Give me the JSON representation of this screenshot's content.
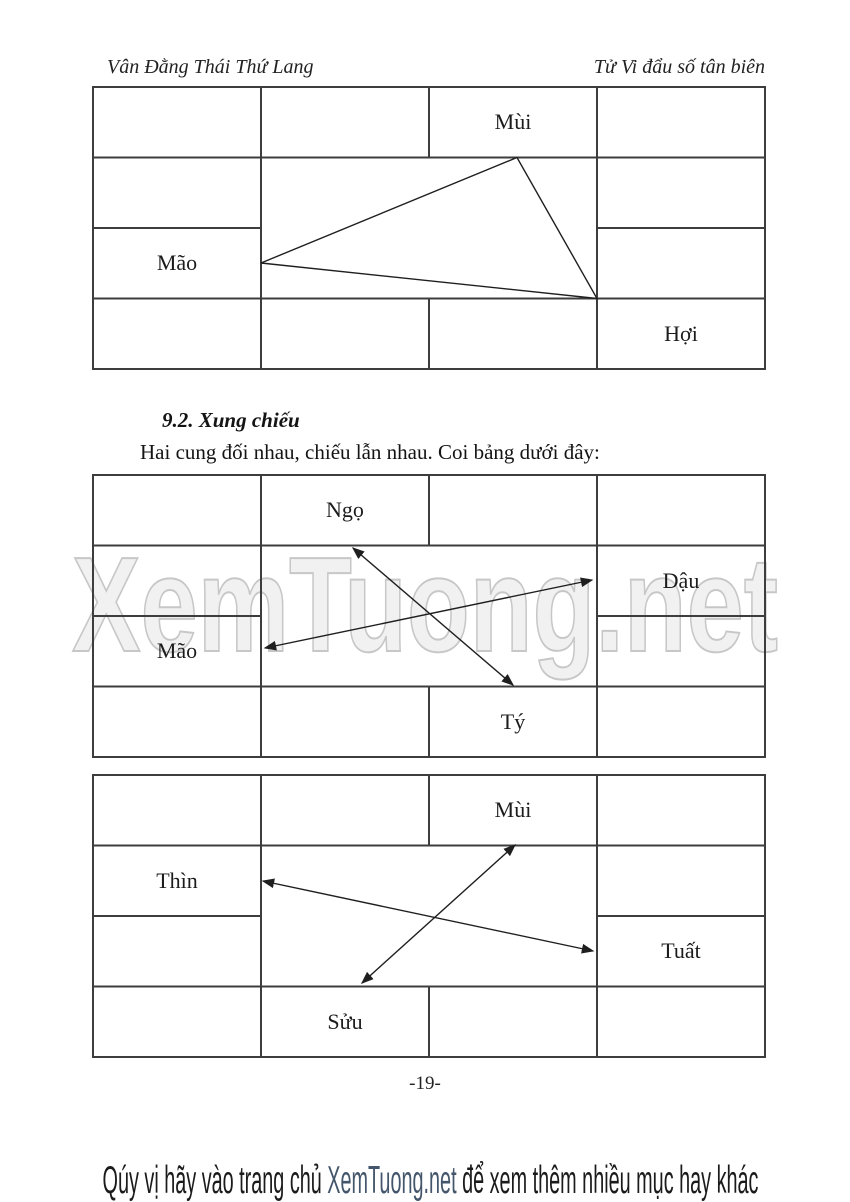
{
  "header": {
    "author": "Vân Đằng Thái Thứ Lang",
    "book_title": "Tử Vi đẩu số tân biên"
  },
  "section": {
    "heading": "9.2. Xung chiếu",
    "intro": "Hai cung đối nhau, chiếu lẫn nhau. Coi bảng dưới đây:"
  },
  "watermark": {
    "text": "XemTuong.net"
  },
  "grid_tam_hop": {
    "labels": {
      "mui": "Mùi",
      "mao": "Mão",
      "hoi": "Hợi"
    }
  },
  "grid_xung_chieu_a": {
    "labels": {
      "ngo": "Ngọ",
      "dau": "Dậu",
      "mao": "Mão",
      "ty": "Tý"
    }
  },
  "grid_xung_chieu_b": {
    "labels": {
      "mui": "Mùi",
      "thin": "Thìn",
      "tuat": "Tuất",
      "suu": "Sửu"
    }
  },
  "footer": {
    "page_number": "-19-",
    "note_prefix": "Qúy vị hãy vào trang chủ ",
    "note_link": "XemTuong.net",
    "note_suffix": " để xem thêm nhiều mục hay khác"
  },
  "colors": {
    "grid_line": "#3d3d3d",
    "arrow": "#1f1f1f",
    "footer_text": "#1b1b1b",
    "footer_link": "#44566b",
    "watermark_fill": "#f1f1f1",
    "watermark_stroke": "#c7c7c7"
  }
}
